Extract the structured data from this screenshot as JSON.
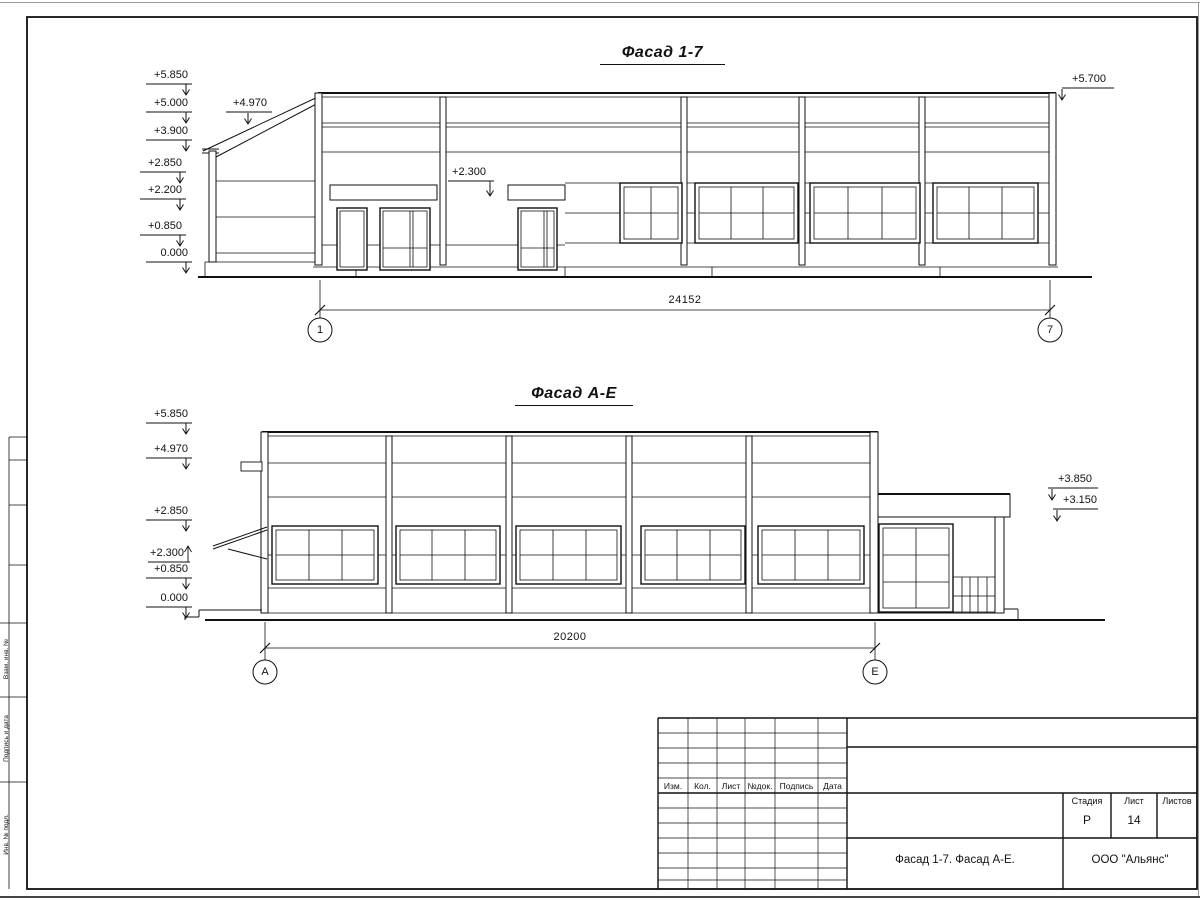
{
  "facade1": {
    "title": "Фасад 1-7",
    "marks_left": [
      "+5.850",
      "+5.000",
      "+3.900",
      "+2.850",
      "+2.200",
      "+0.850",
      "0.000"
    ],
    "mark_canopy": "+4.970",
    "mark_right": "+5.700",
    "mark_entrance": "+2.300",
    "dim": "24152",
    "axis_left": "1",
    "axis_right": "7"
  },
  "facade2": {
    "title": "Фасад А-Е",
    "marks_left": [
      "+5.850",
      "+4.970",
      "+2.850",
      "+2.300",
      "+0.850",
      "0.000"
    ],
    "marks_right": [
      "+3.850",
      "+3.150"
    ],
    "dim": "20200",
    "axis_left": "А",
    "axis_right": "Е"
  },
  "title_block": {
    "header_cols": [
      "Изм.",
      "Кол.",
      "Лист",
      "№док.",
      "Подпись",
      "Дата"
    ],
    "stage_label": "Стадия",
    "sheet_label": "Лист",
    "sheets_label": "Листов",
    "stage": "Р",
    "sheet": "14",
    "doc_title": "Фасад 1-7. Фасад А-Е.",
    "company": "ООО \"Альянс\""
  },
  "side_strip": {
    "labels": [
      "Взам. инв. №",
      "Подпись и дата",
      "Инв. № подл."
    ]
  }
}
